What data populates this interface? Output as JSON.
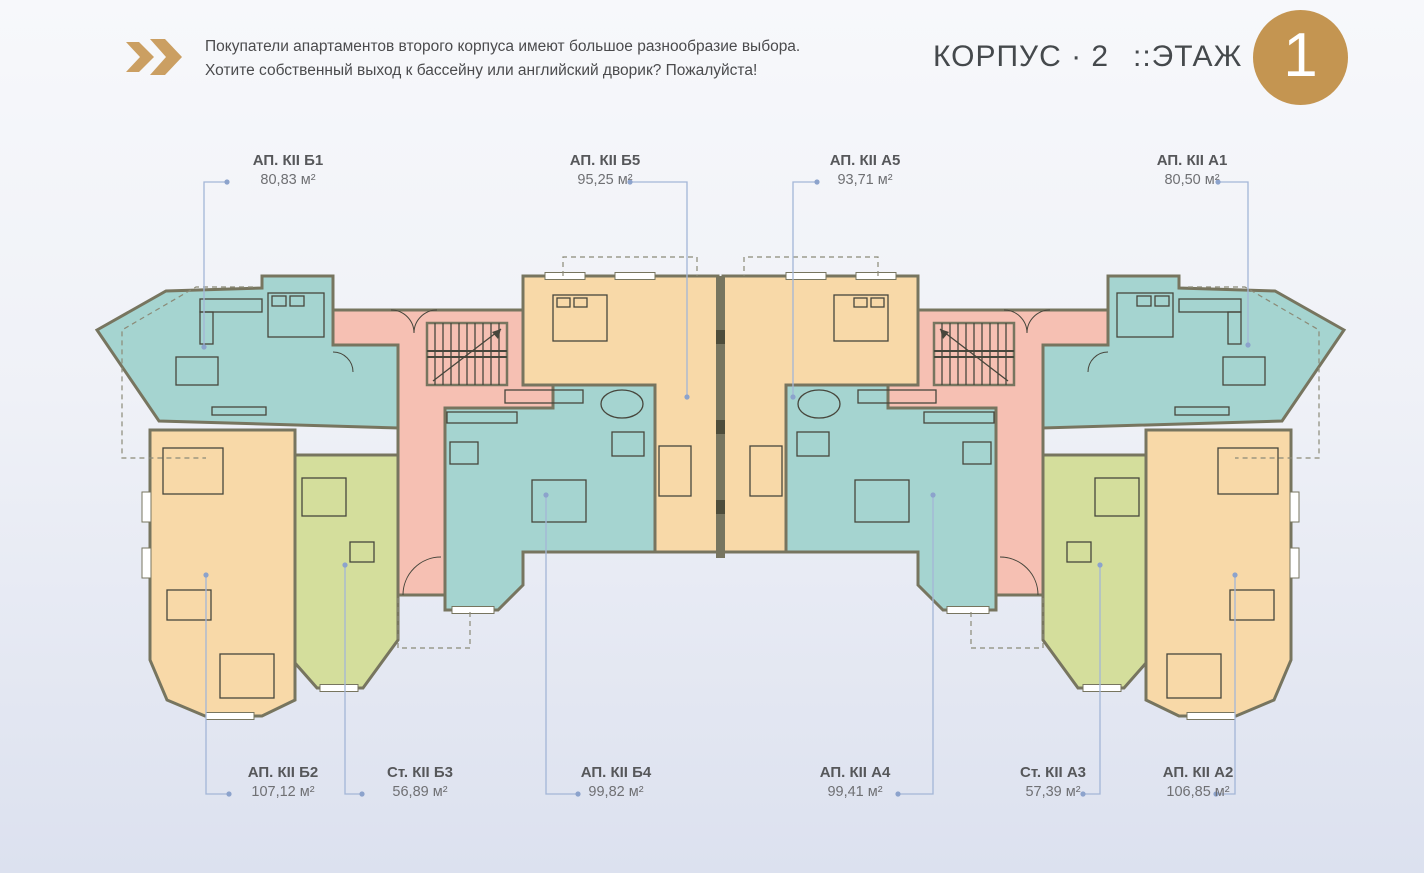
{
  "header": {
    "intro_line1": "Покупатели апартаментов второго корпуса имеют большое разнообразие выбора.",
    "intro_line2": "Хотите собственный выход к бассейну или английский дворик? Пожалуйста!",
    "building_label": "КОРПУС · 2",
    "floor_label": "::ЭТАЖ",
    "floor_number": "1"
  },
  "plan": {
    "colors": {
      "teal": "#A5D4D0",
      "orange": "#F8D9A8",
      "pink": "#F6C0B3",
      "green": "#D4DE9C",
      "wall": "#77755F",
      "wall_dark": "#4E4D3B",
      "furniture": "#47463C",
      "leader": "#A3B6D7",
      "leader_dot": "#8CA3CC",
      "gold": "#C49551",
      "chevron_gold": "#CB9F62",
      "window": "#FFFFFF",
      "dashed": "#8B8A77"
    },
    "apartments": [
      {
        "id": "b1",
        "name": "АП. КII Б1",
        "area": "80,83 м²",
        "color": "teal"
      },
      {
        "id": "b5",
        "name": "АП. КII Б5",
        "area": "95,25 м²",
        "color": "orange"
      },
      {
        "id": "a5",
        "name": "АП. КII А5",
        "area": "93,71 м²",
        "color": "orange"
      },
      {
        "id": "a1",
        "name": "АП. КII А1",
        "area": "80,50 м²",
        "color": "teal"
      },
      {
        "id": "b2",
        "name": "АП. КII Б2",
        "area": "107,12 м²",
        "color": "orange"
      },
      {
        "id": "b3",
        "name": "Ст. КII Б3",
        "area": "56,89 м²",
        "color": "green"
      },
      {
        "id": "b4",
        "name": "АП. КII Б4",
        "area": "99,82 м²",
        "color": "teal"
      },
      {
        "id": "a4",
        "name": "АП. КII А4",
        "area": "99,41 м²",
        "color": "teal"
      },
      {
        "id": "a3",
        "name": "Ст. КII А3",
        "area": "57,39 м²",
        "color": "green"
      },
      {
        "id": "a2",
        "name": "АП. КII А2",
        "area": "106,85 м²",
        "color": "orange"
      }
    ]
  }
}
